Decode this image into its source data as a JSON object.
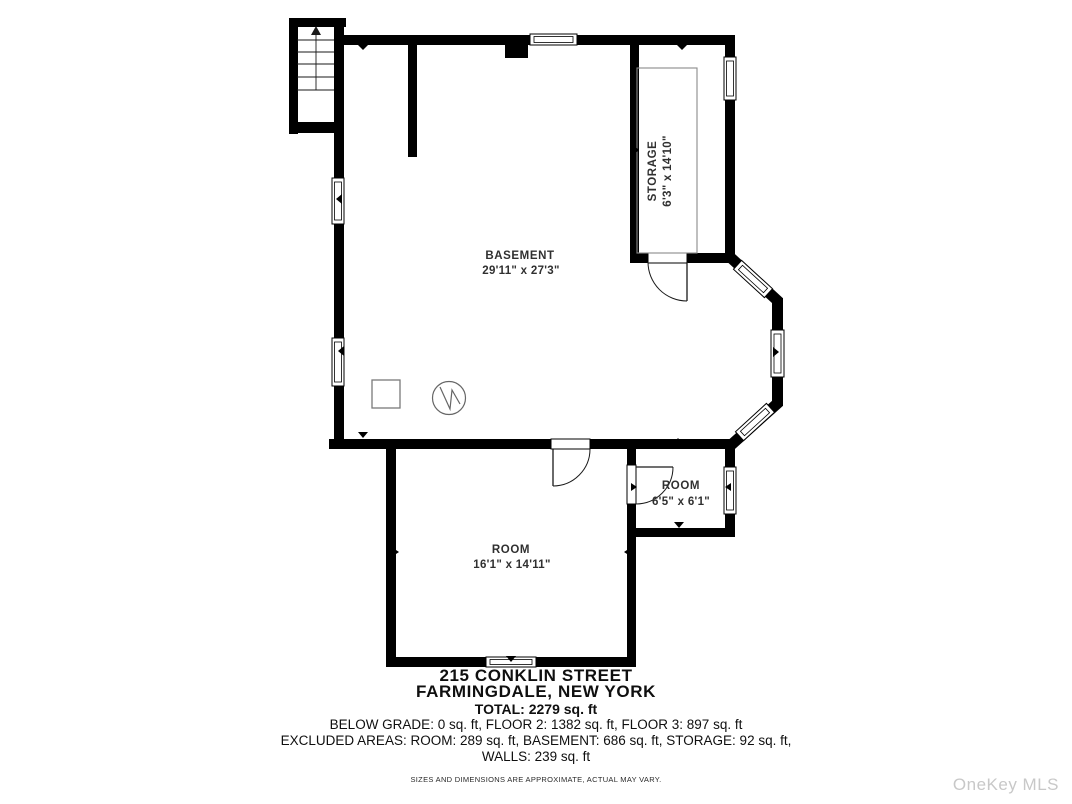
{
  "colors": {
    "wall": "#000000",
    "label": "#303030",
    "fixture": "#7a7a7a",
    "watermark": "#c8c8c8"
  },
  "rooms": {
    "basement": {
      "name": "BASEMENT",
      "dims": "29'11\" x 27'3\""
    },
    "storage": {
      "name": "STORAGE",
      "dims": "6'3\" x 14'10\""
    },
    "small_room": {
      "name": "ROOM",
      "dims": "6'5\" x 6'1\""
    },
    "large_room": {
      "name": "ROOM",
      "dims": "16'1\" x 14'11\""
    }
  },
  "footer": {
    "address_line1": "215 CONKLIN STREET",
    "address_line2": "FARMINGDALE, NEW YORK",
    "total": "TOTAL: 2279 sq. ft",
    "floors_line": "BELOW GRADE: 0 sq. ft, FLOOR 2: 1382 sq. ft, FLOOR 3: 897 sq. ft",
    "excluded_line1": "EXCLUDED AREAS: ROOM: 289 sq. ft, BASEMENT: 686 sq. ft, STORAGE: 92 sq. ft,",
    "excluded_line2": "WALLS: 239 sq. ft",
    "disclaimer": "SIZES AND DIMENSIONS ARE APPROXIMATE, ACTUAL MAY VARY."
  },
  "watermark": "OneKey MLS"
}
